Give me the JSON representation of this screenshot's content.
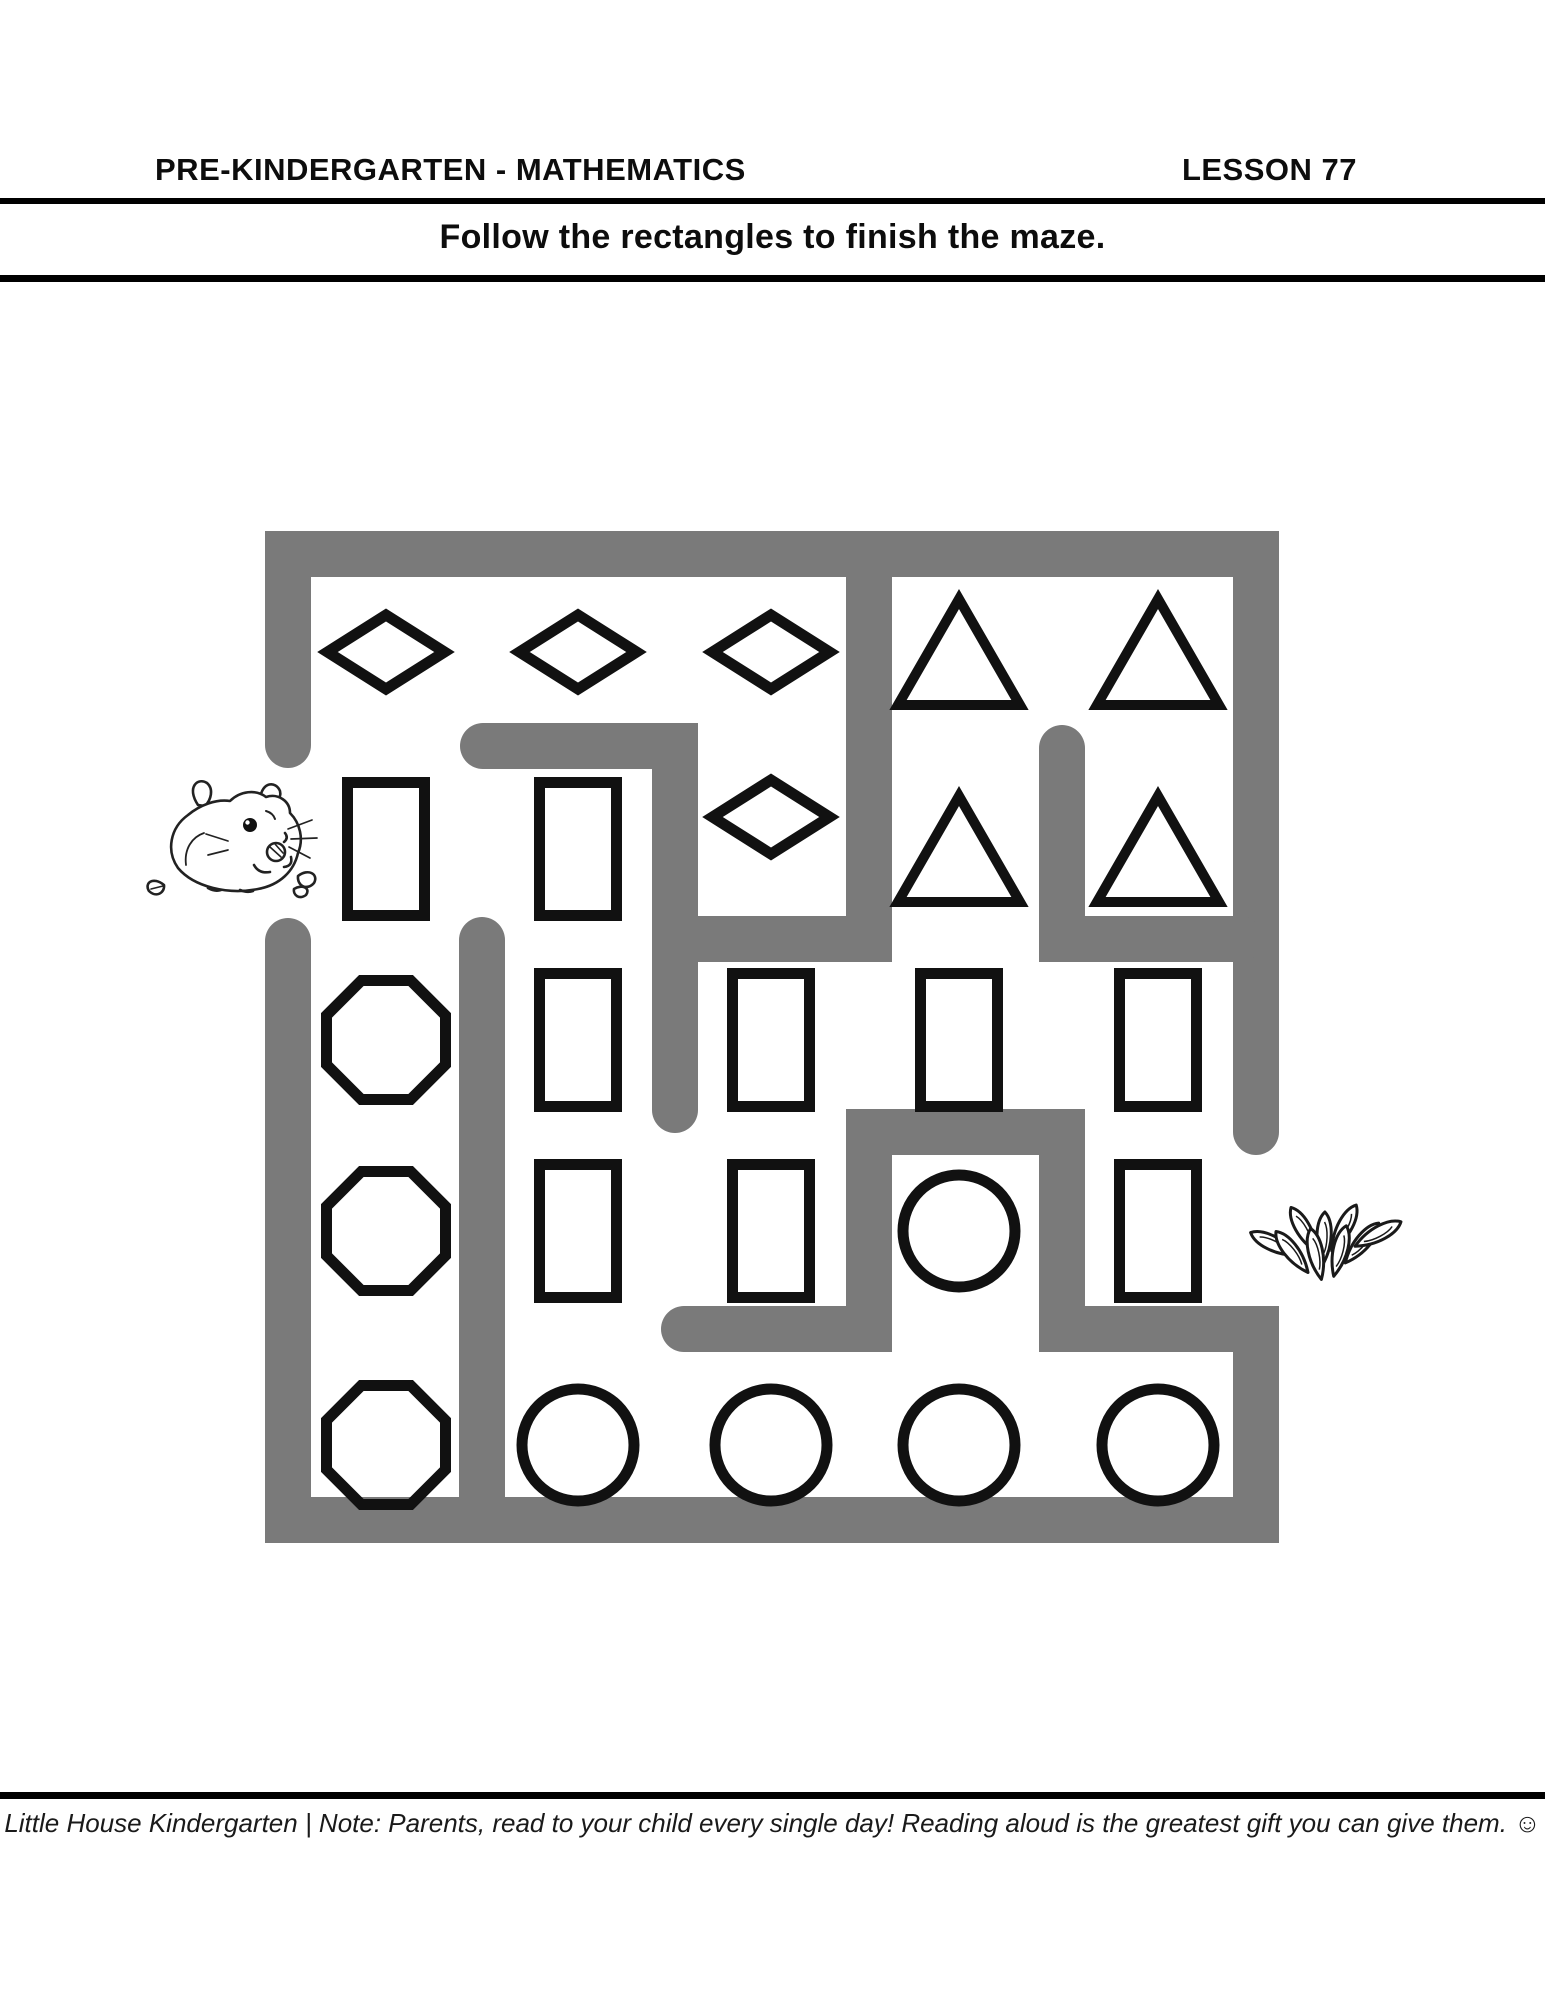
{
  "page": {
    "header": {
      "subject": "PRE-KINDERGARTEN - MATHEMATICS",
      "lesson": "LESSON 77"
    },
    "instruction": "Follow the rectangles to finish the maze.",
    "footer": "Little House Kindergarten | Note: Parents, read to your child every single day! Reading aloud is the greatest gift you can give them. ☺"
  },
  "colors": {
    "wall_gray": "#7a7a7a",
    "ink_black": "#111111",
    "rule_black": "#000000",
    "background": "#ffffff"
  },
  "maze": {
    "rows": 5,
    "cols": 5,
    "entrance_side": "left",
    "exit_side": "right",
    "start_icon": "guinea-pig",
    "end_icon": "sunflower-seeds",
    "wall_thickness": 46,
    "col_centers": [
      386,
      578,
      771,
      959,
      1158
    ],
    "row_centers": [
      652,
      849,
      1040,
      1231,
      1445
    ],
    "shape_grid": [
      [
        "diamond",
        "diamond",
        "diamond",
        "triangle",
        "triangle"
      ],
      [
        "rectangle",
        "rectangle",
        "diamond",
        "triangle",
        "triangle"
      ],
      [
        "octagon",
        "rectangle",
        "rectangle",
        "rectangle",
        "rectangle"
      ],
      [
        "octagon",
        "rectangle",
        "rectangle",
        "circle",
        "rectangle"
      ],
      [
        "octagon",
        "circle",
        "circle",
        "circle",
        "circle"
      ]
    ],
    "shape_offsets": [
      {
        "row": 1,
        "col": 2,
        "dx": 0,
        "dy": -32
      }
    ],
    "shape_sizes": {
      "diamond": {
        "w": 117,
        "h": 74,
        "sw": 11
      },
      "rectangle": {
        "w": 77,
        "h": 133,
        "sw": 11
      },
      "triangle": {
        "w": 122,
        "h": 106,
        "sw": 10
      },
      "octagon": {
        "d": 119,
        "sw": 11
      },
      "circle": {
        "r": 56,
        "sw": 11
      }
    },
    "walls": [
      {
        "name": "outer-top-and-sides",
        "cap": "round",
        "points": [
          [
            288,
            745
          ],
          [
            288,
            554
          ],
          [
            1256,
            554
          ],
          [
            1256,
            1132
          ]
        ]
      },
      {
        "name": "outer-bottom-and-inner-hook",
        "cap": "round",
        "points": [
          [
            288,
            941
          ],
          [
            288,
            1520
          ],
          [
            1256,
            1520
          ],
          [
            1256,
            1329
          ],
          [
            1062,
            1329
          ],
          [
            1062,
            1132
          ],
          [
            869,
            1132
          ],
          [
            869,
            1329
          ],
          [
            684,
            1329
          ]
        ]
      },
      {
        "name": "inner-top-L",
        "cap": "round",
        "points": [
          [
            483,
            746
          ],
          [
            675,
            746
          ],
          [
            675,
            1110
          ]
        ]
      },
      {
        "name": "inner-tee-from-top",
        "cap": "butt",
        "points": [
          [
            869,
            545
          ],
          [
            869,
            939
          ],
          [
            664,
            939
          ]
        ]
      },
      {
        "name": "inner-right-L",
        "cap": "round",
        "points": [
          [
            1062,
            748
          ],
          [
            1062,
            939
          ],
          [
            1240,
            939
          ]
        ]
      },
      {
        "name": "inner-left-divider",
        "cap": "round",
        "points": [
          [
            482,
            940
          ],
          [
            482,
            1510
          ]
        ]
      }
    ]
  }
}
